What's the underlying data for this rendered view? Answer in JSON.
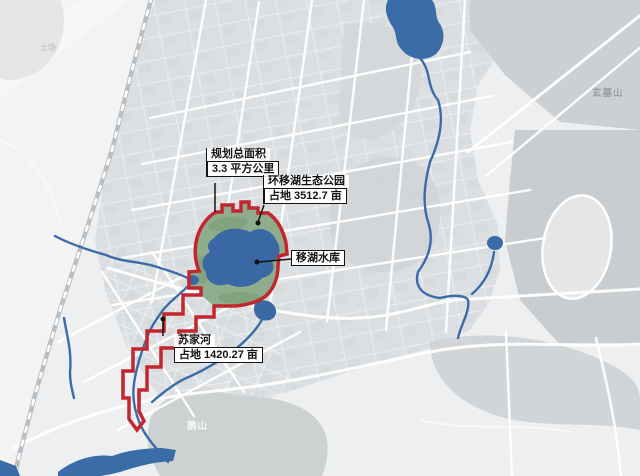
{
  "map": {
    "callouts": {
      "planning_area": {
        "title": "规划总面积",
        "value": "3.3 平方公里"
      },
      "eco_park": {
        "title": "环移湖生态公园",
        "value": "占地 3512.7 亩"
      },
      "reservoir": {
        "label": "移湖水库"
      },
      "sujia_river": {
        "title": "苏家河",
        "value": "占地 1420.27 亩"
      }
    },
    "place_labels": {
      "xuanmu_mountain": "玄墓山",
      "e_mountain": "鹅山",
      "tuchang": "土场"
    },
    "colors": {
      "boundary_red": "#c2272d",
      "park_green": "#8fad8c",
      "lake_blue": "#3a68a5",
      "river_blue": "#3a6ca8",
      "base_gray": "#edeff0",
      "hill_gray": "#cbcfd2",
      "road_white": "#ffffff",
      "label_ink": "#141414"
    }
  }
}
